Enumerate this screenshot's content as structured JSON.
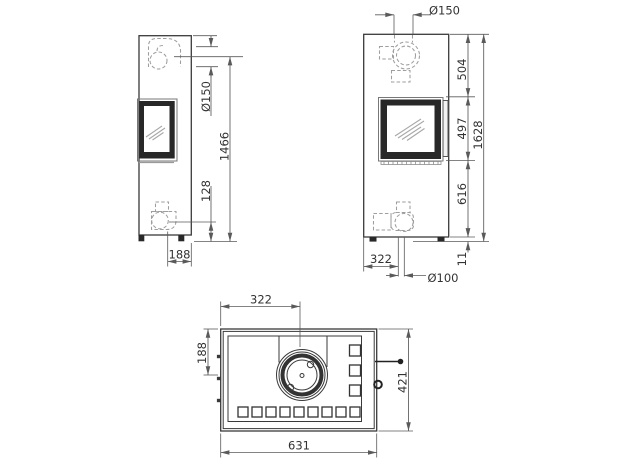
{
  "drawing": {
    "side": {
      "flue_dia": "Ø150",
      "flue_height": "1466",
      "intake_height": "128",
      "intake_depth": "188"
    },
    "front": {
      "flue_dia": "Ø150",
      "top_to_door": "504",
      "door_height": "497",
      "door_to_base": "616",
      "total_height": "1628",
      "intake_offset": "322",
      "intake_dia": "Ø100",
      "foot_height": "11"
    },
    "top": {
      "flue_offset_x": "322",
      "flue_offset_y": "188",
      "width": "631",
      "depth": "421"
    }
  }
}
